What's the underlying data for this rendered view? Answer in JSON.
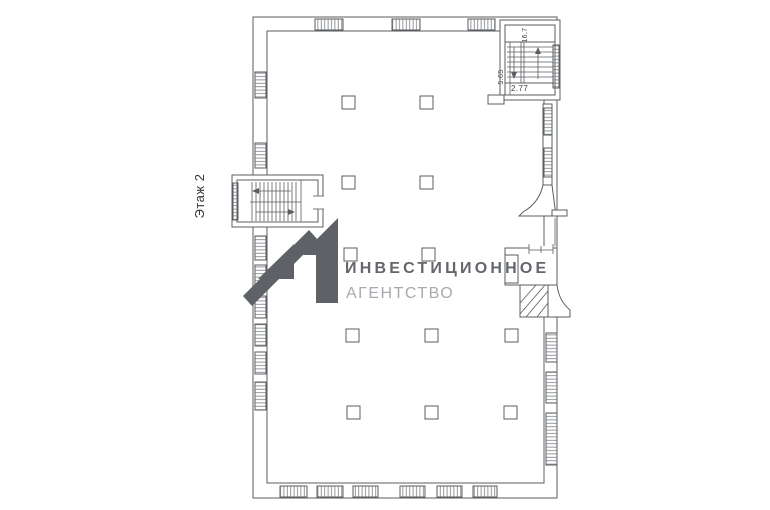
{
  "canvas": {
    "width": 770,
    "height": 510,
    "background": "#ffffff"
  },
  "plan": {
    "floor_label": "Этаж 2",
    "line_color": "#5a5d61",
    "label_color": "#36383b",
    "stair_labels": {
      "width": "2.77",
      "depth": "5.65",
      "area": "16.7"
    }
  },
  "watermark": {
    "title": "ИНВЕСТИЦИОННОЕ",
    "subtitle": "АГЕНТСТВО",
    "mark_color": "#5e6266",
    "title_color": "#63676b",
    "subtitle_color": "#a6aaae"
  }
}
